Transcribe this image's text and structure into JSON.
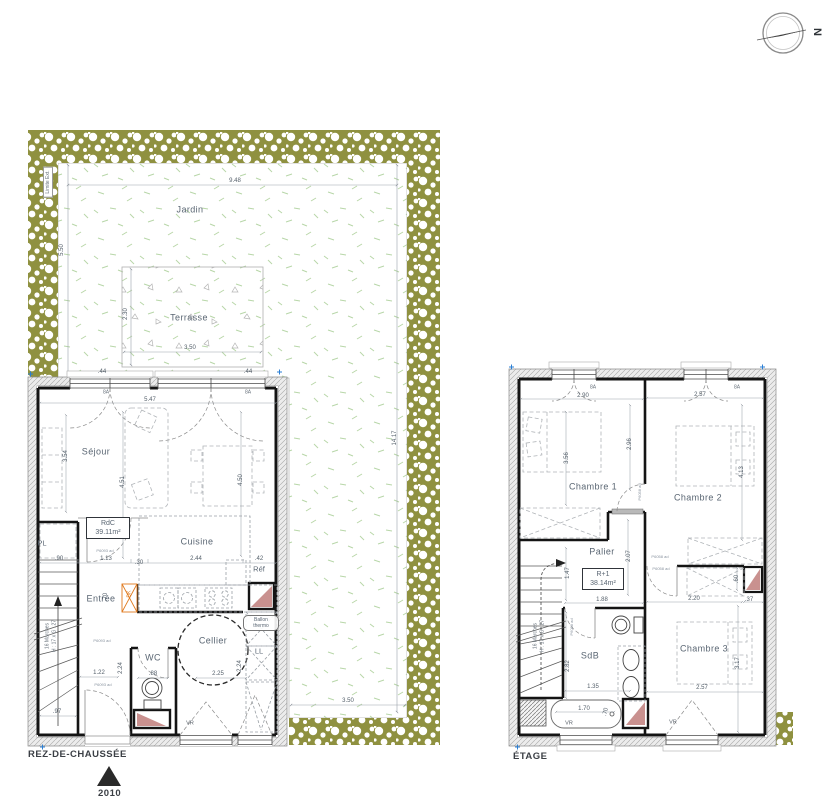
{
  "colors": {
    "hedge_olive": "#8f9140",
    "grass_green": "#b8d6a8",
    "shaft_pink": "#c9918f",
    "wall_black": "#141414",
    "label_text": "#5a6673",
    "accent_orange": "#e07a1e",
    "marker_blue": "#2b7fd4"
  },
  "north_indicator": {
    "label": "N"
  },
  "site": {
    "boundary_label": "Limite Ext."
  },
  "ground_floor": {
    "title": "REZ-DE-CHAUSSÉE",
    "entry_marker": "2010",
    "area_tag": {
      "name": "RdC",
      "area": "39.11m²"
    },
    "water_heater": {
      "line1": "Ballon",
      "line2": "thermo"
    }
  },
  "upper_floor": {
    "title": "ÉTAGE",
    "area_tag": {
      "name": "R+1",
      "area": "38.14m²"
    }
  },
  "labels": {
    "site": [
      {
        "t": "Jardin",
        "x": 190,
        "y": 210,
        "c": "room",
        "n": "jardin-label"
      },
      {
        "t": "Terrasse",
        "x": 189,
        "y": 318,
        "c": "room",
        "n": "terrasse-label"
      },
      {
        "t": "9.48",
        "x": 235,
        "y": 181,
        "c": "dim"
      },
      {
        "t": "5.50",
        "x": 62,
        "y": 250,
        "r": -90,
        "c": "dim"
      },
      {
        "t": "14.17",
        "x": 395,
        "y": 438,
        "r": -90,
        "c": "dim"
      },
      {
        "t": "3.50",
        "x": 348,
        "y": 701,
        "c": "dim"
      },
      {
        "t": "2.30",
        "x": 126,
        "y": 314,
        "r": -90,
        "c": "dim"
      },
      {
        "t": "3.50",
        "x": 190,
        "y": 348,
        "c": "dim"
      }
    ],
    "ground": [
      {
        "t": "Séjour",
        "x": 96,
        "y": 452,
        "c": "room",
        "n": "sejour-label"
      },
      {
        "t": "Cuisine",
        "x": 197,
        "y": 542,
        "c": "room",
        "n": "cuisine-label"
      },
      {
        "t": "Entrée",
        "x": 101,
        "y": 599,
        "c": "room",
        "n": "entree-label"
      },
      {
        "t": "Cellier",
        "x": 213,
        "y": 641,
        "c": "room",
        "n": "cellier-label"
      },
      {
        "t": "WC",
        "x": 153,
        "y": 658,
        "c": "room",
        "n": "wc-label"
      },
      {
        "t": "Réf",
        "x": 259,
        "y": 569,
        "c": "small",
        "n": "ref-label"
      },
      {
        "t": "PL",
        "x": 42,
        "y": 543,
        "c": "small",
        "n": "pl-label"
      },
      {
        "t": "LL",
        "x": 259,
        "y": 651,
        "c": "small",
        "n": "ll-label"
      },
      {
        "t": "5.47",
        "x": 150,
        "y": 400,
        "c": "dim"
      },
      {
        "t": "3.54",
        "x": 66,
        "y": 456,
        "r": -90,
        "c": "dim"
      },
      {
        "t": "4.51",
        "x": 123,
        "y": 482,
        "r": -90,
        "c": "dim"
      },
      {
        "t": "4.50",
        "x": 241,
        "y": 480,
        "r": -90,
        "c": "dim"
      },
      {
        "t": ".90",
        "x": 59,
        "y": 559,
        "c": "dim"
      },
      {
        "t": "1.13",
        "x": 106,
        "y": 559,
        "c": "dim"
      },
      {
        "t": ".30",
        "x": 139,
        "y": 563,
        "c": "dim"
      },
      {
        "t": "2.44",
        "x": 196,
        "y": 559,
        "c": "dim"
      },
      {
        "t": ".42",
        "x": 259,
        "y": 559,
        "c": "dim"
      },
      {
        "t": ".70",
        "x": 106,
        "y": 597,
        "r": -90,
        "c": "dim"
      },
      {
        "t": ".97",
        "x": 57,
        "y": 712,
        "c": "dim"
      },
      {
        "t": "1.22",
        "x": 99,
        "y": 673,
        "c": "dim"
      },
      {
        "t": "2.24",
        "x": 121,
        "y": 668,
        "r": -90,
        "c": "dim"
      },
      {
        "t": ".88",
        "x": 153,
        "y": 674,
        "c": "dim"
      },
      {
        "t": "2.25",
        "x": 218,
        "y": 674,
        "c": "dim"
      },
      {
        "t": "2.24",
        "x": 240,
        "y": 666,
        "r": -90,
        "c": "dim"
      },
      {
        "t": ".44",
        "x": 102,
        "y": 372,
        "c": "dim"
      },
      {
        "t": ".44",
        "x": 248,
        "y": 372,
        "c": "dim"
      },
      {
        "t": "8A",
        "x": 106,
        "y": 393,
        "c": "tiny"
      },
      {
        "t": "8A",
        "x": 248,
        "y": 393,
        "c": "tiny"
      },
      {
        "t": "16 Marches",
        "x": 48,
        "y": 636,
        "r": -90,
        "c": "tiny",
        "n": "stair-note"
      },
      {
        "t": "H : 17 x G : 27",
        "x": 55,
        "y": 636,
        "r": -90,
        "c": "tiny",
        "n": "stair-note"
      },
      {
        "t": "DK",
        "x": 130,
        "y": 594,
        "r": -90,
        "c": "orange",
        "n": "duct-label"
      },
      {
        "t": "P6093 ad",
        "x": 105,
        "y": 551,
        "c": "code"
      },
      {
        "t": "P6093 ad",
        "x": 102,
        "y": 641,
        "c": "code"
      },
      {
        "t": "P6093 ad",
        "x": 103,
        "y": 685,
        "c": "code"
      },
      {
        "t": "VR",
        "x": 190,
        "y": 724,
        "c": "vr"
      }
    ],
    "upper": [
      {
        "t": "Chambre 1",
        "x": 593,
        "y": 487,
        "c": "room",
        "n": "chambre1-label"
      },
      {
        "t": "Chambre 2",
        "x": 698,
        "y": 498,
        "c": "room",
        "n": "chambre2-label"
      },
      {
        "t": "Chambre 3",
        "x": 704,
        "y": 649,
        "c": "room",
        "n": "chambre3-label"
      },
      {
        "t": "Palier",
        "x": 602,
        "y": 552,
        "c": "room",
        "n": "palier-label"
      },
      {
        "t": "SdB",
        "x": 590,
        "y": 656,
        "c": "room",
        "n": "sdb-label"
      },
      {
        "t": "2.90",
        "x": 583,
        "y": 396,
        "c": "dim"
      },
      {
        "t": "2.57",
        "x": 700,
        "y": 395,
        "c": "dim"
      },
      {
        "t": "8A",
        "x": 593,
        "y": 388,
        "c": "tiny"
      },
      {
        "t": "8A",
        "x": 737,
        "y": 388,
        "c": "tiny"
      },
      {
        "t": "3.56",
        "x": 567,
        "y": 458,
        "r": -90,
        "c": "dim"
      },
      {
        "t": "2.96",
        "x": 630,
        "y": 444,
        "r": -90,
        "c": "dim"
      },
      {
        "t": "4.13",
        "x": 742,
        "y": 472,
        "r": -90,
        "c": "dim"
      },
      {
        "t": "2.07",
        "x": 629,
        "y": 556,
        "r": -90,
        "c": "dim"
      },
      {
        "t": "1.47",
        "x": 568,
        "y": 573,
        "r": -90,
        "c": "dim"
      },
      {
        "t": "1.88",
        "x": 602,
        "y": 600,
        "c": "dim"
      },
      {
        "t": "2.20",
        "x": 694,
        "y": 599,
        "c": "dim"
      },
      {
        "t": ".37",
        "x": 749,
        "y": 600,
        "c": "dim"
      },
      {
        "t": ".60",
        "x": 737,
        "y": 579,
        "r": -90,
        "c": "dim"
      },
      {
        "t": "1.35",
        "x": 593,
        "y": 687,
        "c": "dim"
      },
      {
        "t": "2.82",
        "x": 568,
        "y": 666,
        "r": -90,
        "c": "dim"
      },
      {
        "t": "2.57",
        "x": 702,
        "y": 688,
        "c": "dim"
      },
      {
        "t": "3.17",
        "x": 738,
        "y": 663,
        "r": -90,
        "c": "dim"
      },
      {
        "t": "1.70",
        "x": 584,
        "y": 709,
        "c": "dim"
      },
      {
        "t": ".70",
        "x": 606,
        "y": 712,
        "r": -75,
        "c": "dim"
      },
      {
        "t": "16 Marches",
        "x": 536,
        "y": 636,
        "r": -90,
        "c": "tiny",
        "n": "stair-note"
      },
      {
        "t": "H : 17 x G : 27",
        "x": 543,
        "y": 636,
        "r": -90,
        "c": "tiny",
        "n": "stair-note"
      },
      {
        "t": "P6058 ad",
        "x": 660,
        "y": 557,
        "c": "code"
      },
      {
        "t": "P6058 ad",
        "x": 661,
        "y": 569,
        "c": "code"
      },
      {
        "t": "P6088 ad",
        "x": 572,
        "y": 627,
        "r": -90,
        "c": "code"
      },
      {
        "t": "P6058 ad",
        "x": 640,
        "y": 492,
        "r": -90,
        "c": "code"
      },
      {
        "t": "VR",
        "x": 569,
        "y": 724,
        "c": "vr"
      },
      {
        "t": "VR",
        "x": 673,
        "y": 723,
        "c": "vr"
      }
    ]
  }
}
